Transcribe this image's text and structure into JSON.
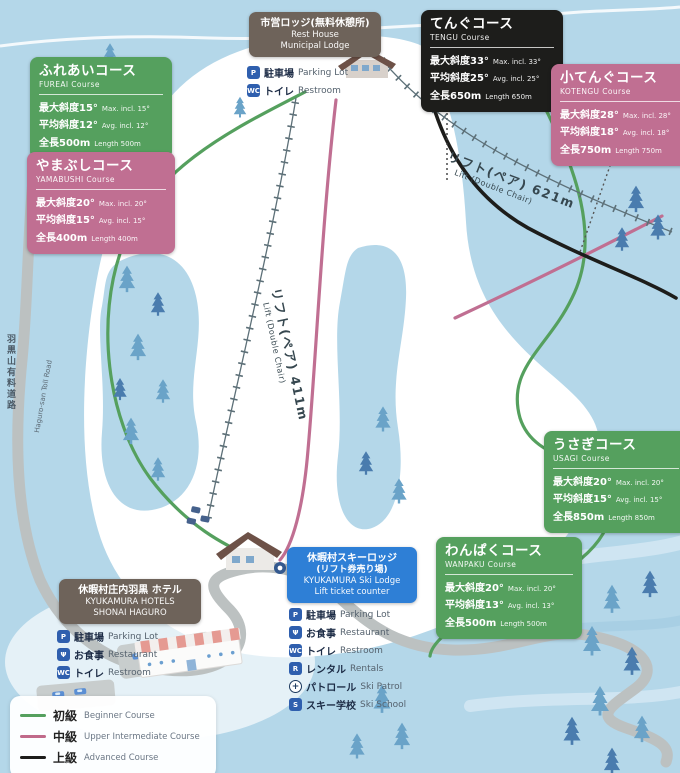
{
  "courses": {
    "fureai": {
      "title": "ふれあいコース",
      "subtitle": "FUREAI Course",
      "color": "#55a05e",
      "specs": [
        {
          "ja": "最大斜度15°",
          "en": "Max. incl. 15°"
        },
        {
          "ja": "平均斜度12°",
          "en": "Avg. incl. 12°"
        },
        {
          "ja": "全長500m",
          "en": "Length 500m"
        }
      ]
    },
    "yamabushi": {
      "title": "やまぶしコース",
      "subtitle": "YAMABUSHI Course",
      "color": "#c06f92",
      "specs": [
        {
          "ja": "最大斜度20°",
          "en": "Max. incl. 20°"
        },
        {
          "ja": "平均斜度15°",
          "en": "Avg. incl. 15°"
        },
        {
          "ja": "全長400m",
          "en": "Length 400m"
        }
      ]
    },
    "tengu": {
      "title": "てんぐコース",
      "subtitle": "TENGU Course",
      "color": "#1d1d1b",
      "specs": [
        {
          "ja": "最大斜度33°",
          "en": "Max. incl. 33°"
        },
        {
          "ja": "平均斜度25°",
          "en": "Avg. incl. 25°"
        },
        {
          "ja": "全長650m",
          "en": "Length 650m"
        }
      ]
    },
    "kotengu": {
      "title": "小てんぐコース",
      "subtitle": "KOTENGU Course",
      "color": "#c06f92",
      "specs": [
        {
          "ja": "最大斜度28°",
          "en": "Max. incl. 28°"
        },
        {
          "ja": "平均斜度18°",
          "en": "Avg. incl. 18°"
        },
        {
          "ja": "全長750m",
          "en": "Length 750m"
        }
      ]
    },
    "usagi": {
      "title": "うさぎコース",
      "subtitle": "USAGI Course",
      "color": "#55a05e",
      "specs": [
        {
          "ja": "最大斜度20°",
          "en": "Max. incl. 20°"
        },
        {
          "ja": "平均斜度15°",
          "en": "Avg. incl. 15°"
        },
        {
          "ja": "全長850m",
          "en": "Length 850m"
        }
      ]
    },
    "wanpaku": {
      "title": "わんぱくコース",
      "subtitle": "WANPAKU Course",
      "color": "#55a05e",
      "specs": [
        {
          "ja": "最大斜度20°",
          "en": "Max. incl. 20°"
        },
        {
          "ja": "平均斜度13°",
          "en": "Avg. incl. 13°"
        },
        {
          "ja": "全長500m",
          "en": "Length 500m"
        }
      ]
    }
  },
  "facilities": {
    "municipal": {
      "color": "#6e635a",
      "title": "市営ロッジ(無料休憩所)",
      "lines": [
        "Rest House",
        "Municipal Lodge"
      ],
      "services": [
        {
          "icon": "P",
          "ja": "駐車場",
          "en": "Parking Lot"
        },
        {
          "icon": "WC",
          "ja": "トイレ",
          "en": "Restroom"
        }
      ]
    },
    "skilodge": {
      "color": "#2e7fd6",
      "title": "休暇村スキーロッジ",
      "subtitle": "(リフト券売り場)",
      "lines": [
        "KYUKAMURA Ski Lodge",
        "Lift ticket counter"
      ],
      "services": [
        {
          "icon": "P",
          "ja": "駐車場",
          "en": "Parking Lot"
        },
        {
          "icon": "Ψ",
          "ja": "お食事",
          "en": "Restaurant"
        },
        {
          "icon": "WC",
          "ja": "トイレ",
          "en": "Restroom"
        },
        {
          "icon": "R",
          "ja": "レンタル",
          "en": "Rentals"
        },
        {
          "icon": "+",
          "ja": "パトロール",
          "en": "Ski Patrol"
        },
        {
          "icon": "S",
          "ja": "スキー学校",
          "en": "Ski School"
        }
      ]
    },
    "hotel": {
      "color": "#6e635a",
      "title": "休暇村庄内羽黒 ホテル",
      "lines": [
        "KYUKAMURA HOTELS",
        "SHONAI HAGURO"
      ],
      "services": [
        {
          "icon": "P",
          "ja": "駐車場",
          "en": "Parking Lot"
        },
        {
          "icon": "Ψ",
          "ja": "お食事",
          "en": "Restaurant"
        },
        {
          "icon": "WC",
          "ja": "トイレ",
          "en": "Restroom"
        }
      ]
    }
  },
  "lifts": {
    "pair621": {
      "ja": "リフト(ペア) 621m",
      "en": "Lift (Double Chair)"
    },
    "pair411": {
      "ja": "リフト(ペア) 411m",
      "en": "Lift (Double Chair)"
    }
  },
  "toll_road": {
    "ja": "羽黒山有料道路",
    "en": "Haguro-san Toll Road"
  },
  "legend": {
    "items": [
      {
        "ja": "初級",
        "en": "Beginner Course",
        "color": "#55a05e"
      },
      {
        "ja": "中級",
        "en": "Upper Intermediate Course",
        "color": "#c06a8a"
      },
      {
        "ja": "上級",
        "en": "Advanced Course",
        "color": "#1d1d1b"
      }
    ]
  },
  "map_colors": {
    "background": "#b4d7e9",
    "slope": "#ffffff",
    "road": "#bcc1c1",
    "beginner": "#55a05e",
    "intermediate": "#c06f92",
    "advanced": "#1d1d1b",
    "lift": "#5d7078",
    "tree_light": "#6aa3c8",
    "tree_dark": "#4a7cae"
  }
}
